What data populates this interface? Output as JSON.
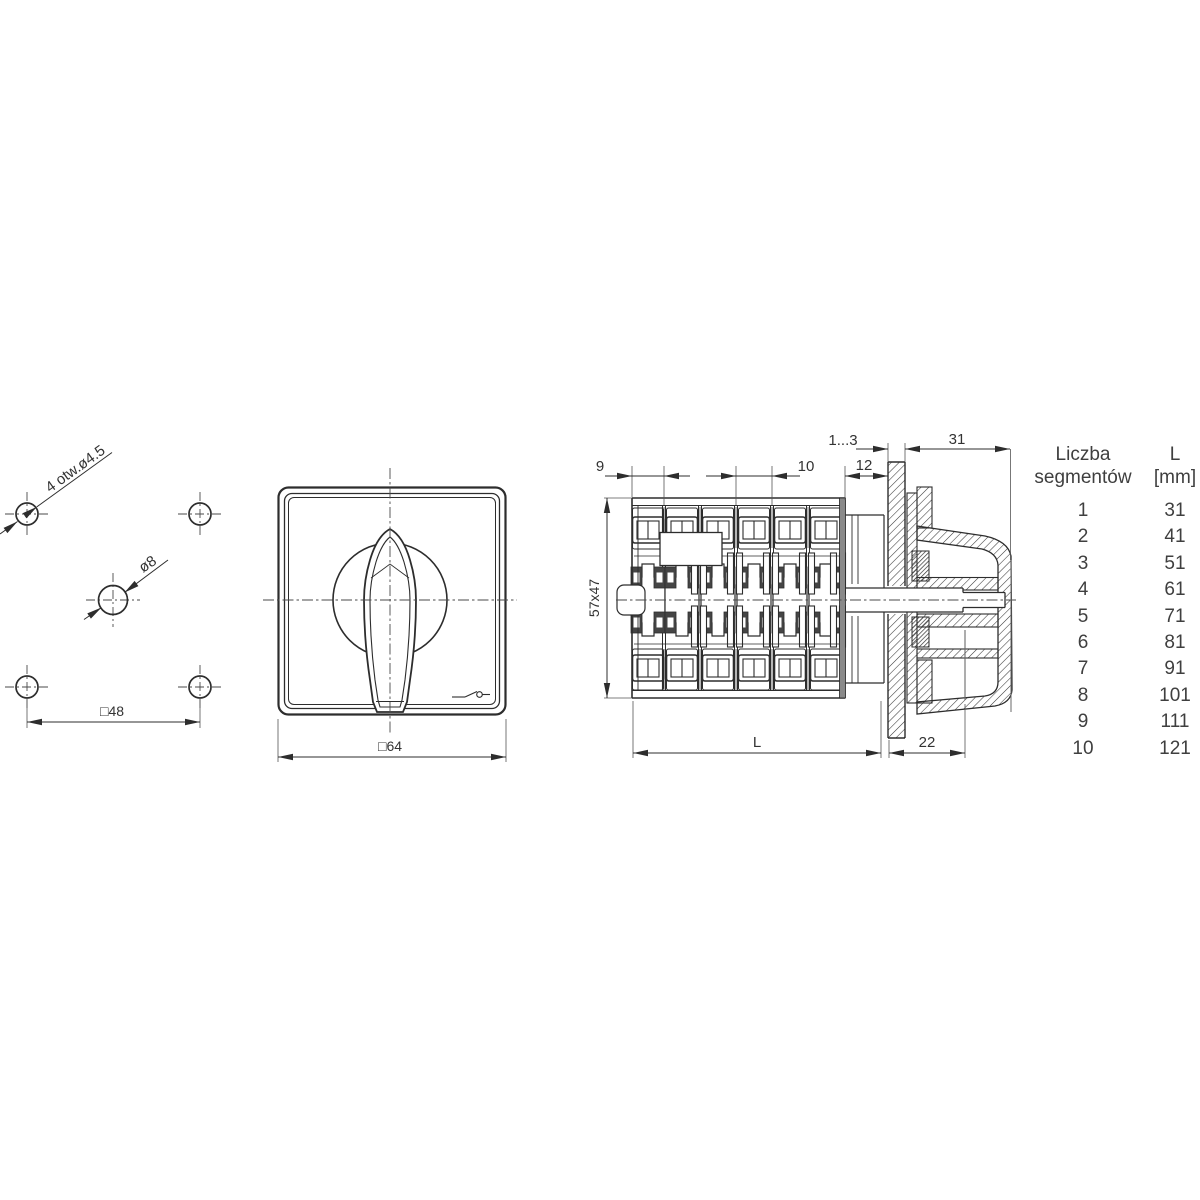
{
  "hole_pattern": {
    "corner_holes_label": "4 otw.ø4.5",
    "center_hole_label": "ø8",
    "hole_spacing_label": "□48"
  },
  "front_view": {
    "width_label": "□64"
  },
  "side_view": {
    "dims": {
      "first_segment": "9",
      "segment_pitch": "10",
      "panel_thickness": "1...3",
      "behind_panel": "12",
      "front_depth": "31",
      "body_cross_section": "57x47",
      "body_length": "L",
      "knob_depth": "22"
    }
  },
  "table": {
    "header": {
      "col1_line1": "Liczba",
      "col1_line2": "segmentów",
      "col2_line1": "L",
      "col2_line2": "[mm]"
    },
    "rows": [
      {
        "segments": "1",
        "l": "31"
      },
      {
        "segments": "2",
        "l": "41"
      },
      {
        "segments": "3",
        "l": "51"
      },
      {
        "segments": "4",
        "l": "61"
      },
      {
        "segments": "5",
        "l": "71"
      },
      {
        "segments": "6",
        "l": "81"
      },
      {
        "segments": "7",
        "l": "91"
      },
      {
        "segments": "8",
        "l": "101"
      },
      {
        "segments": "9",
        "l": "111"
      },
      {
        "segments": "10",
        "l": "121"
      }
    ]
  },
  "colors": {
    "line": "#2d2d2d",
    "centerline": "#4a4a4a",
    "dark_fill": "#454545",
    "gray_fill": "#8a8a8a"
  }
}
